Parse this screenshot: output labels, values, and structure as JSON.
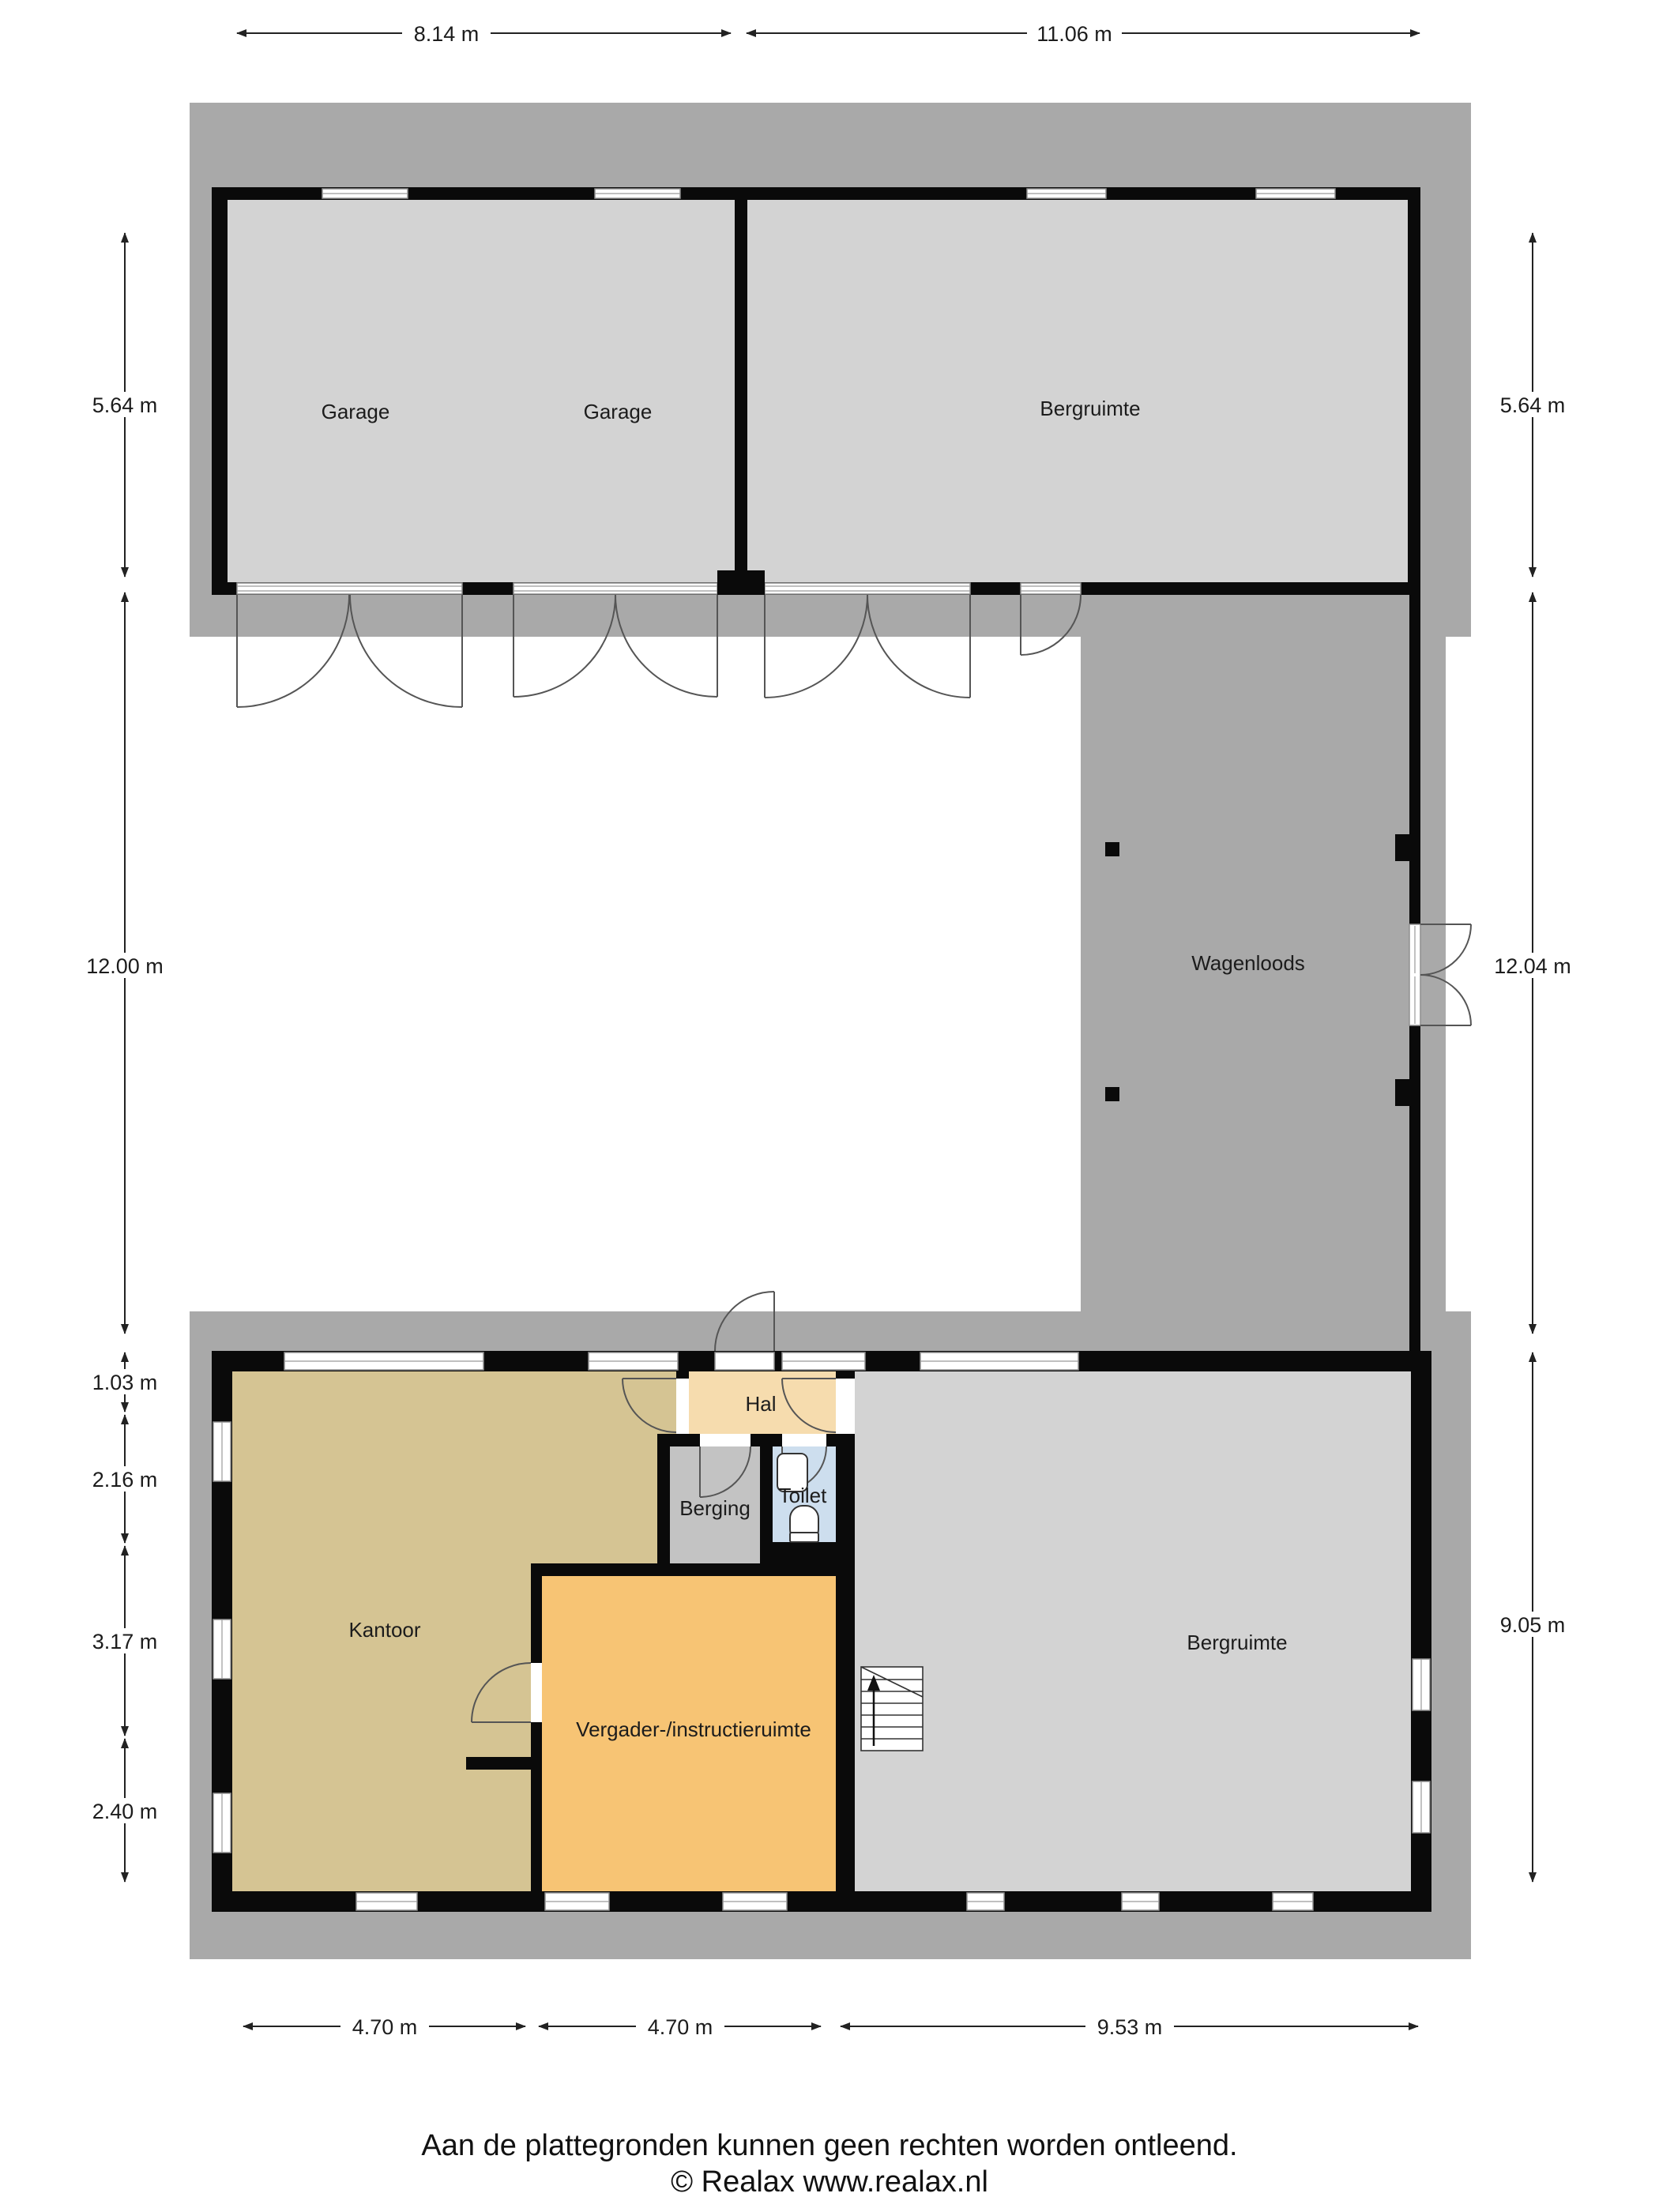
{
  "title": "Floor plan (plattegrond)",
  "rooms": {
    "garage_left": {
      "label": "Garage"
    },
    "garage_right": {
      "label": "Garage"
    },
    "bergruimte_top": {
      "label": "Bergruimte"
    },
    "wagenloods": {
      "label": "Wagenloods"
    },
    "hal": {
      "label": "Hal"
    },
    "berging": {
      "label": "Berging"
    },
    "toilet": {
      "label": "Toilet"
    },
    "kantoor": {
      "label": "Kantoor"
    },
    "vergader": {
      "label": "Vergader-/instructieruimte"
    },
    "bergruimte_bottom": {
      "label": "Bergruimte"
    }
  },
  "dimensions": {
    "top": [
      "8.14 m",
      "11.06 m"
    ],
    "left": [
      "5.64 m",
      "12.00 m",
      "1.03 m",
      "2.16 m",
      "3.17 m",
      "2.40 m"
    ],
    "right": [
      "5.64 m",
      "12.04 m",
      "9.05 m"
    ],
    "bottom": [
      "4.70 m",
      "4.70 m",
      "9.53 m"
    ]
  },
  "footer": {
    "disclaimer": "Aan de plattegronden kunnen geen rechten worden ontleend.",
    "copyright": "© Realax www.realax.nl"
  },
  "colors": {
    "site_gray": "#a9a9a9",
    "floor_gray": "#d3d3d3",
    "wall_black": "#0a0a0a",
    "kantoor_tan": "#d5c493",
    "hal_peach": "#f6dcae",
    "berging_gray": "#c3c3c3",
    "toilet_blue": "#cddeee",
    "vergader_orange": "#f7c474"
  }
}
